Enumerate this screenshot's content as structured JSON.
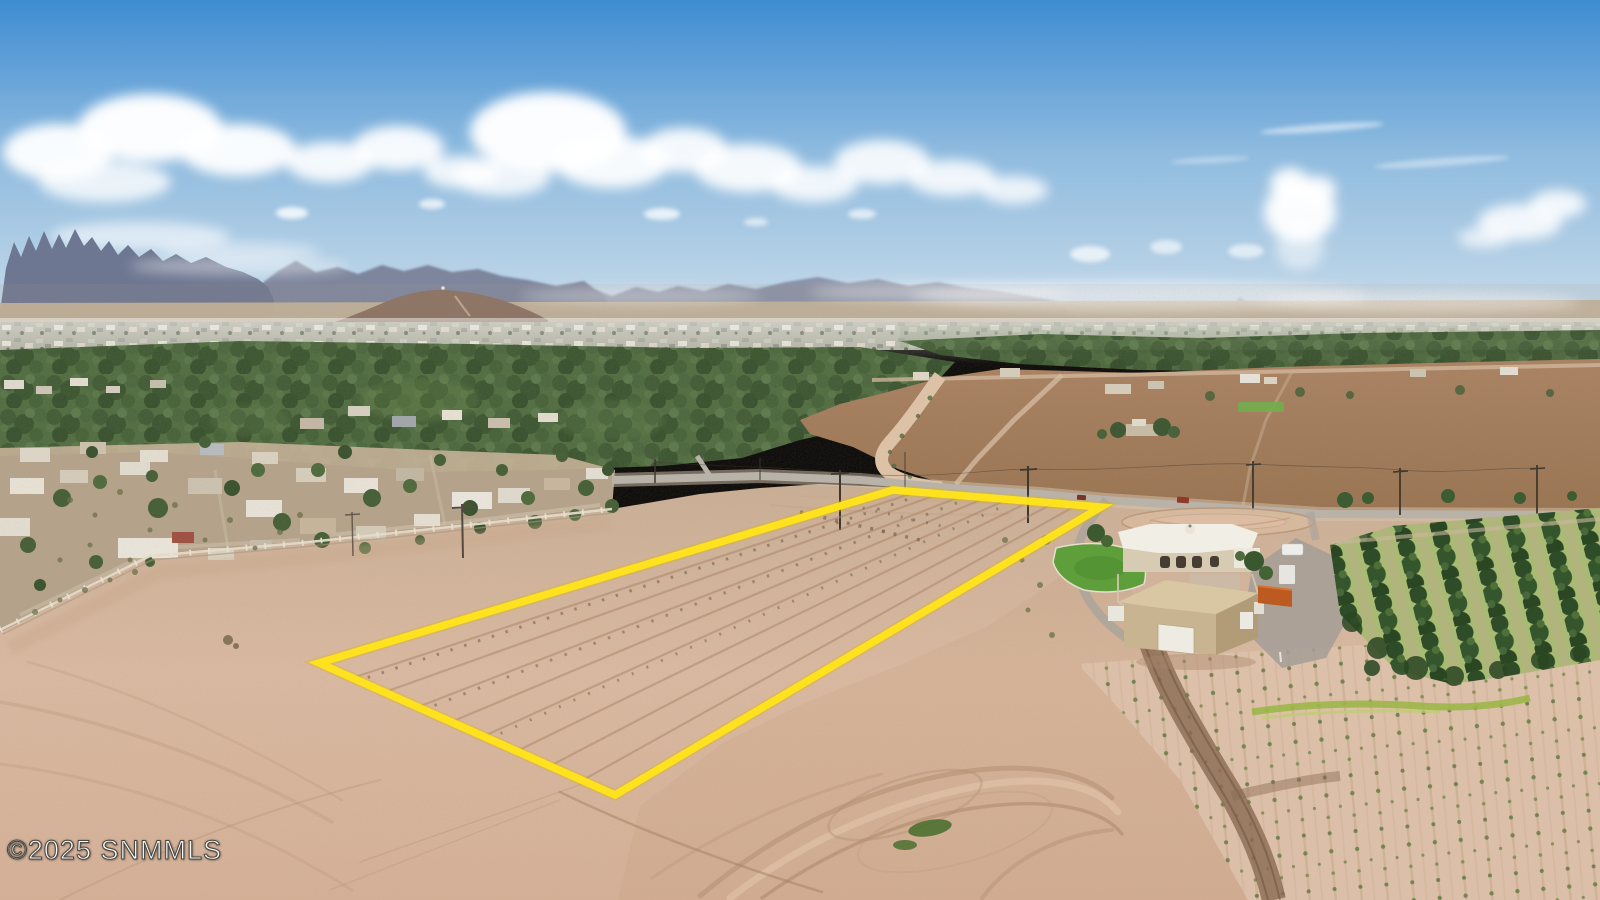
{
  "watermark": {
    "text": "©2025 SNMMLS"
  },
  "boundary": {
    "points": "319,663 893,490 1101,507 615,795",
    "color": "#FFE31C",
    "glow_color": "#D9B40E"
  },
  "colors": {
    "sky_top": "#3E8CD2",
    "sky_mid": "#8FBBDF",
    "sky_horizon": "#CEDEEA",
    "cloud_white": "#FFFFFF",
    "mountain_far": "#9DA9BC",
    "mountain_near": "#6E7792",
    "foothill": "#8B7263",
    "plain_tan": "#C2B29A",
    "city_gray": "#A8AC9C",
    "tree_dark": "#3A5730",
    "tree_mid": "#4A6A3C",
    "field_top": "#A98160",
    "field_bottom": "#97714E",
    "ditch_sand": "#E3C7AB",
    "sand_top": "#CCB197",
    "sand_mid": "#DDBCA3",
    "sand_bottom": "#D8B299",
    "road_gray": "#B8B2A8",
    "lawn_green": "#5E9E3B",
    "barn_tan": "#C8B490",
    "container_orange": "#BC5A22",
    "grass_strip": "#9CB648",
    "orchard_green": "#2E4C27",
    "track_brown": "#B08B6E"
  }
}
